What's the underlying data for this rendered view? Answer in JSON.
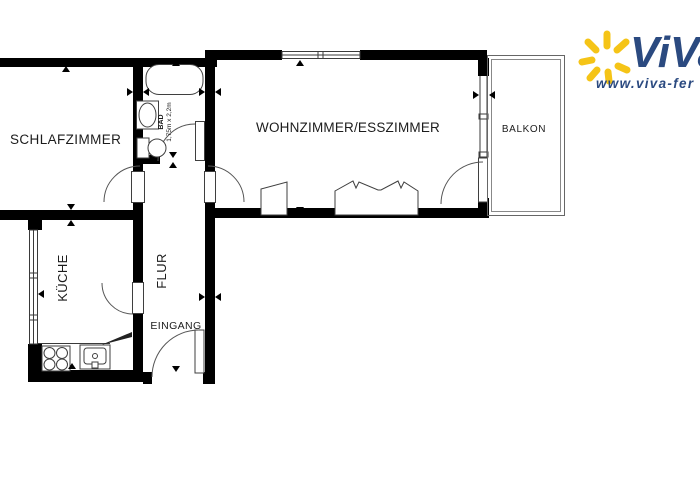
{
  "colors": {
    "wall": "#000000",
    "line": "#3a3a3a",
    "background": "#ffffff",
    "logo_blue": "#2b4a80",
    "logo_yellow": "#f5c417"
  },
  "rooms": {
    "schlafzimmer": {
      "label": "SCHLAFZIMMER"
    },
    "wohnzimmer": {
      "label": "WOHNZIMMER/ESSZIMMER"
    },
    "balkon": {
      "label": "BALKON"
    },
    "kueche": {
      "label": "KÜCHE"
    },
    "flur": {
      "label": "FLUR"
    },
    "eingang": {
      "label": "EINGANG"
    },
    "bad": {
      "label": "BAD",
      "dimensions": "1,75m x 2,2m"
    }
  },
  "logo": {
    "brand": "ViVa",
    "website": "www.viva-fer"
  }
}
